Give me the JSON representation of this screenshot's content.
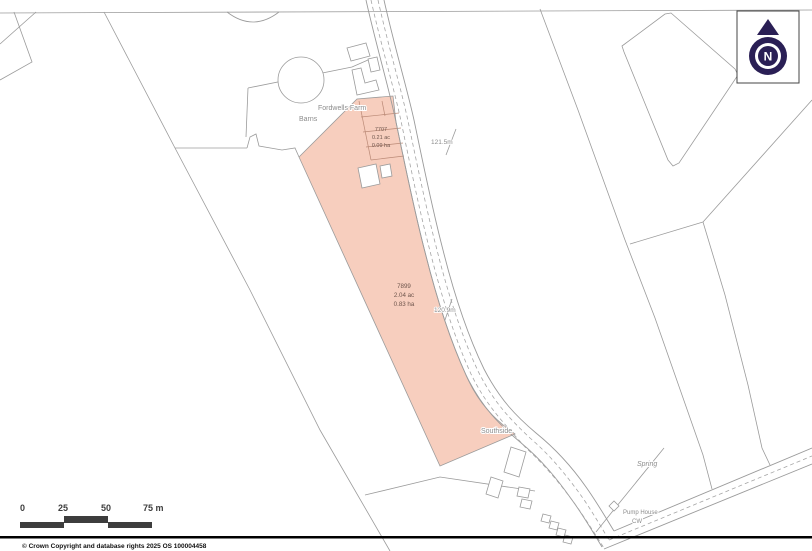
{
  "north": {
    "letter": "N"
  },
  "map_labels": {
    "farm": "Fordwells Farm",
    "barns": "Barns",
    "southside": "Southside",
    "spring": "Spring",
    "pump_house": "Pump House",
    "cw": "CW",
    "spot_height_upper": "121.5m",
    "spot_height_lower": "120.9m"
  },
  "parcels": [
    {
      "number": "7707",
      "acres": "0.21 ac",
      "hectares": "0.09 ha"
    },
    {
      "number": "7899",
      "acres": "2.04 ac",
      "hectares": "0.83 ha"
    }
  ],
  "scale_bar": {
    "tick0": "0",
    "tick1": "25",
    "tick2": "50",
    "tick3": "75 m"
  },
  "footer": {
    "copyright": "© Crown Copyright and database rights 2025 OS 100004458"
  },
  "colors": {
    "parcel_fill": "#f7cebe",
    "line": "#9b9b9b",
    "north": "#2a1f55",
    "scale": "#3d3d3d"
  }
}
